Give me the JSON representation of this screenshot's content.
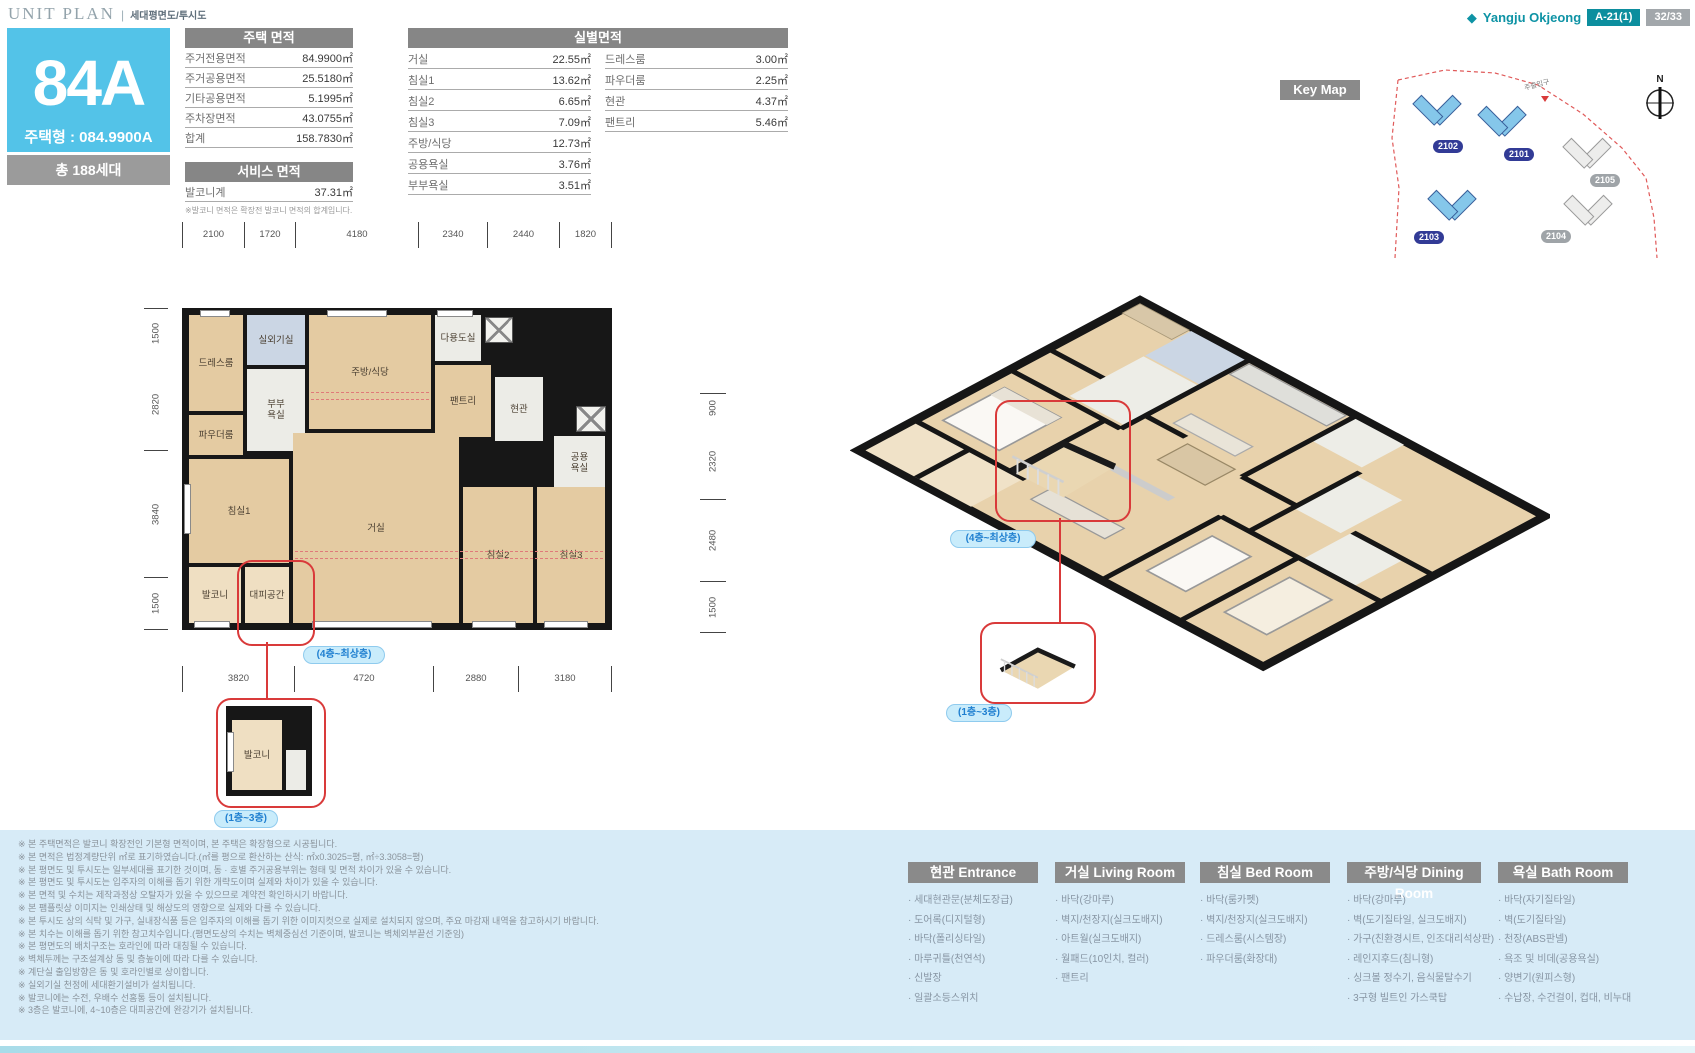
{
  "header": {
    "title": "UNIT PLAN",
    "divider": "|",
    "subtitle": "세대평면도/투시도",
    "brand": "Yangju Okjeong",
    "block_badge": "A-21(1)",
    "page_badge": "32/33"
  },
  "unit_card": {
    "name": "84A",
    "type": "주택형 : 084.9900A",
    "households": "총 188세대"
  },
  "house_area_table": {
    "title": "주택 면적",
    "rows": [
      {
        "label": "주거전용면적",
        "value": "84.9900㎡"
      },
      {
        "label": "주거공용면적",
        "value": "25.5180㎡"
      },
      {
        "label": "기타공용면적",
        "value": "5.1995㎡"
      },
      {
        "label": "주차장면적",
        "value": "43.0755㎡"
      },
      {
        "label": "합계",
        "value": "158.7830㎡"
      }
    ]
  },
  "service_area_table": {
    "title": "서비스 면적",
    "rows": [
      {
        "label": "발코니계",
        "value": "37.31㎡"
      }
    ],
    "note": "※발코니 면적은 확장전 발코니 면적의 합계입니다."
  },
  "room_area_table": {
    "title": "실별면적",
    "left_rows": [
      {
        "label": "거실",
        "value": "22.55㎡"
      },
      {
        "label": "침실1",
        "value": "13.62㎡"
      },
      {
        "label": "침실2",
        "value": "6.65㎡"
      },
      {
        "label": "침실3",
        "value": "7.09㎡"
      },
      {
        "label": "주방/식당",
        "value": "12.73㎡"
      },
      {
        "label": "공용욕실",
        "value": "3.76㎡"
      },
      {
        "label": "부부욕실",
        "value": "3.51㎡"
      }
    ],
    "right_rows": [
      {
        "label": "드레스룸",
        "value": "3.00㎡"
      },
      {
        "label": "파우더룸",
        "value": "2.25㎡"
      },
      {
        "label": "현관",
        "value": "4.37㎡"
      },
      {
        "label": "팬트리",
        "value": "5.46㎡"
      }
    ]
  },
  "floor_plan": {
    "dims_top": [
      "2100",
      "1720",
      "4180",
      "2340",
      "2440",
      "1820"
    ],
    "dims_bottom": [
      "3820",
      "4720",
      "2880",
      "3180"
    ],
    "dims_left": [
      "1500",
      "2820",
      "3840",
      "1500"
    ],
    "dims_right": [
      "900",
      "2320",
      "2480",
      "1500"
    ],
    "rooms": {
      "dress_room": "드레스룸",
      "outdoor_unit": "실외기실",
      "master_bath": "부부욕실",
      "powder_room": "파우더룸",
      "kitchen_dining": "주방/식당",
      "utility": "다용도실",
      "pantry": "팬트리",
      "entry": "현관",
      "common_bath": "공용욕실",
      "bedroom1": "침실1",
      "living": "거실",
      "bedroom2": "침실2",
      "bedroom3": "침실3",
      "balcony": "발코니",
      "shelter": "대피공간"
    },
    "detail_balcony": "발코니",
    "callout_upper": "(4층~최상층)",
    "callout_lower": "(1층~3층)"
  },
  "key_map": {
    "title": "Key Map",
    "compass": "N",
    "entrance": "주출입구",
    "buildings": [
      {
        "label": "2102",
        "active": true
      },
      {
        "label": "2101",
        "active": true
      },
      {
        "label": "2105",
        "active": false
      },
      {
        "label": "2103",
        "active": true
      },
      {
        "label": "2104",
        "active": false
      }
    ]
  },
  "perspective": {
    "callout_upper": "(4층~최상층)",
    "callout_lower": "(1층~3층)"
  },
  "notes": [
    "※ 본 주택면적은 발코니 확장전인 기본형 면적이며, 본 주택은 확장형으로 시공됩니다.",
    "※ 본 면적은 법정계량단위 ㎡로 표기하였습니다.(㎡를 평으로 환산하는 산식: ㎡x0.3025=평, ㎡÷3.3058=평)",
    "※ 본 평면도 및 투시도는 일부세대를 표기한 것이며, 동 · 호별 주거공용부위는 형태 및 면적 차이가 있을 수 있습니다.",
    "※ 본 평면도 및 투시도는 입주자의 이해를 돕기 위한 개략도이며 실제와 차이가 있을 수 있습니다.",
    "※ 본 면적 및 수치는 제작과정상 오탈자가 있을 수 있으므로 계약전 확인하시기 바랍니다.",
    "※ 본 팸플릿상 이미지는 인쇄상태 및 해상도의 영향으로 실제와 다를 수 있습니다.",
    "※ 본 투시도 상의 식탁 및 가구, 실내장식품 등은 입주자의 이해를 돕기 위한 이미지컷으로 실제로 설치되지 않으며, 주요 마감재 내역을 참고하시기 바랍니다.",
    "※ 본 치수는 이해를 돕기 위한 참고치수입니다.(평면도상의 수치는 벽체중심선 기준이며, 발코니는 벽체외부끝선 기준임)",
    "※ 본 평면도의 배치구조는 호라인에 따라 대칭될 수 있습니다.",
    "※ 벽체두께는 구조설계상 동 및 층높이에 따라 다를 수 있습니다.",
    "※ 계단실 출입방향은 동 및 호라인별로 상이합니다.",
    "※ 실외기실 천정에 세대환기설비가 설치됩니다.",
    "※ 발코니에는 수전, 우배수 선홈통 등이 설치됩니다.",
    "※ 3층은 발코니에, 4~10층은 대피공간에 완강기가 설치됩니다."
  ],
  "spec_tables": [
    {
      "title": "현관 Entrance",
      "items": [
        "세대현관문(분체도장급)",
        "도어록(디지털형)",
        "바닥(폴리싱타일)",
        "마루귀틀(천연석)",
        "신발장",
        "일괄소등스위치"
      ]
    },
    {
      "title": "거실 Living Room",
      "items": [
        "바닥(강마루)",
        "벽지/천장지(실크도배지)",
        "아트월(실크도배지)",
        "월패드(10인치, 컬러)",
        "팬트리"
      ]
    },
    {
      "title": "침실 Bed Room",
      "items": [
        "바닥(룸카펫)",
        "벽지/천장지(실크도배지)",
        "드레스룸(시스템장)",
        "파우더룸(화장대)"
      ]
    },
    {
      "title": "주방/식당 Dining Room",
      "items": [
        "바닥(강마루)",
        "벽(도기질타일, 실크도배지)",
        "가구(친환경시트, 인조대리석상판)",
        "레인지후드(침니형)",
        "싱크볼 정수기, 음식물탈수기",
        "3구형 빌트인 가스쿡탑"
      ]
    },
    {
      "title": "욕실 Bath Room",
      "items": [
        "바닥(자기질타일)",
        "벽(도기질타일)",
        "천장(ABS판넬)",
        "욕조 및 비데(공용욕실)",
        "양변기(원피스형)",
        "수납장, 수건걸이, 컵대, 비누대"
      ]
    }
  ],
  "colors": {
    "accent_cyan": "#53C3E8",
    "brand_teal": "#0E93A5",
    "header_gray": "#8A8A8A",
    "band_blue": "#D7EBF7",
    "callout_red": "#D93A3A",
    "wood": "#E4CBA2"
  }
}
